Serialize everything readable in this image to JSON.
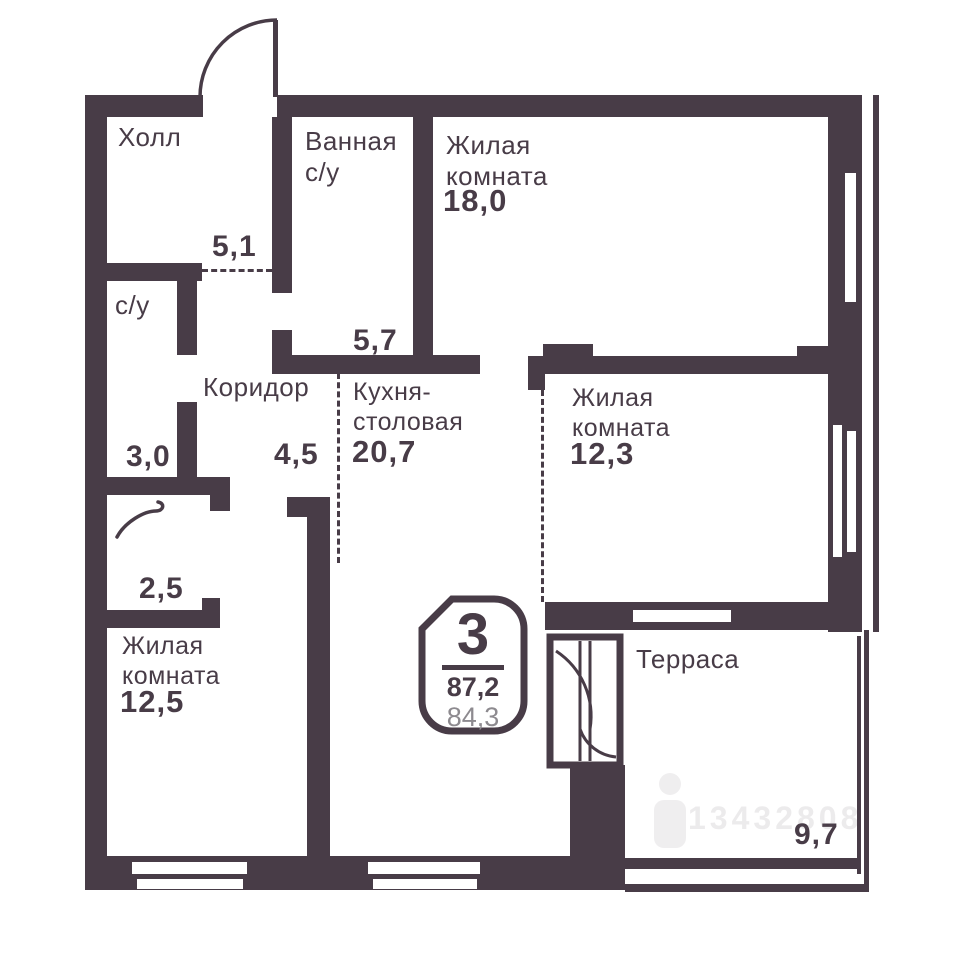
{
  "plan": {
    "badge": {
      "rooms_count": "3",
      "area_total": "87,2",
      "area_living": "84,3"
    },
    "rooms": {
      "hall": {
        "label": "Холл",
        "area": "5,1"
      },
      "bathroom": {
        "label": "Ванная\nс/у",
        "area": "5,7"
      },
      "living_top": {
        "label": "Жилая\nкомната",
        "area": "18,0"
      },
      "wc": {
        "label": "с/у",
        "area": "3,0"
      },
      "corridor": {
        "label": "Коридор",
        "area": "4,5"
      },
      "kitchen_dining": {
        "label": "Кухня-\nстоловая",
        "area": "20,7"
      },
      "living_mid": {
        "label": "Жилая\nкомната",
        "area": "12,3"
      },
      "wardrobe": {
        "area": "2,5"
      },
      "living_bottom": {
        "label": "Жилая\nкомната",
        "area": "12,5"
      },
      "terrace": {
        "label": "Терраса",
        "area": "9,7"
      }
    },
    "watermark": {
      "id": "13432808"
    },
    "colors": {
      "wall": "#483c47",
      "text": "#483c47",
      "muted_area": "#8d8a8f",
      "background": "#ffffff",
      "watermark": "#6b5f6b"
    }
  }
}
